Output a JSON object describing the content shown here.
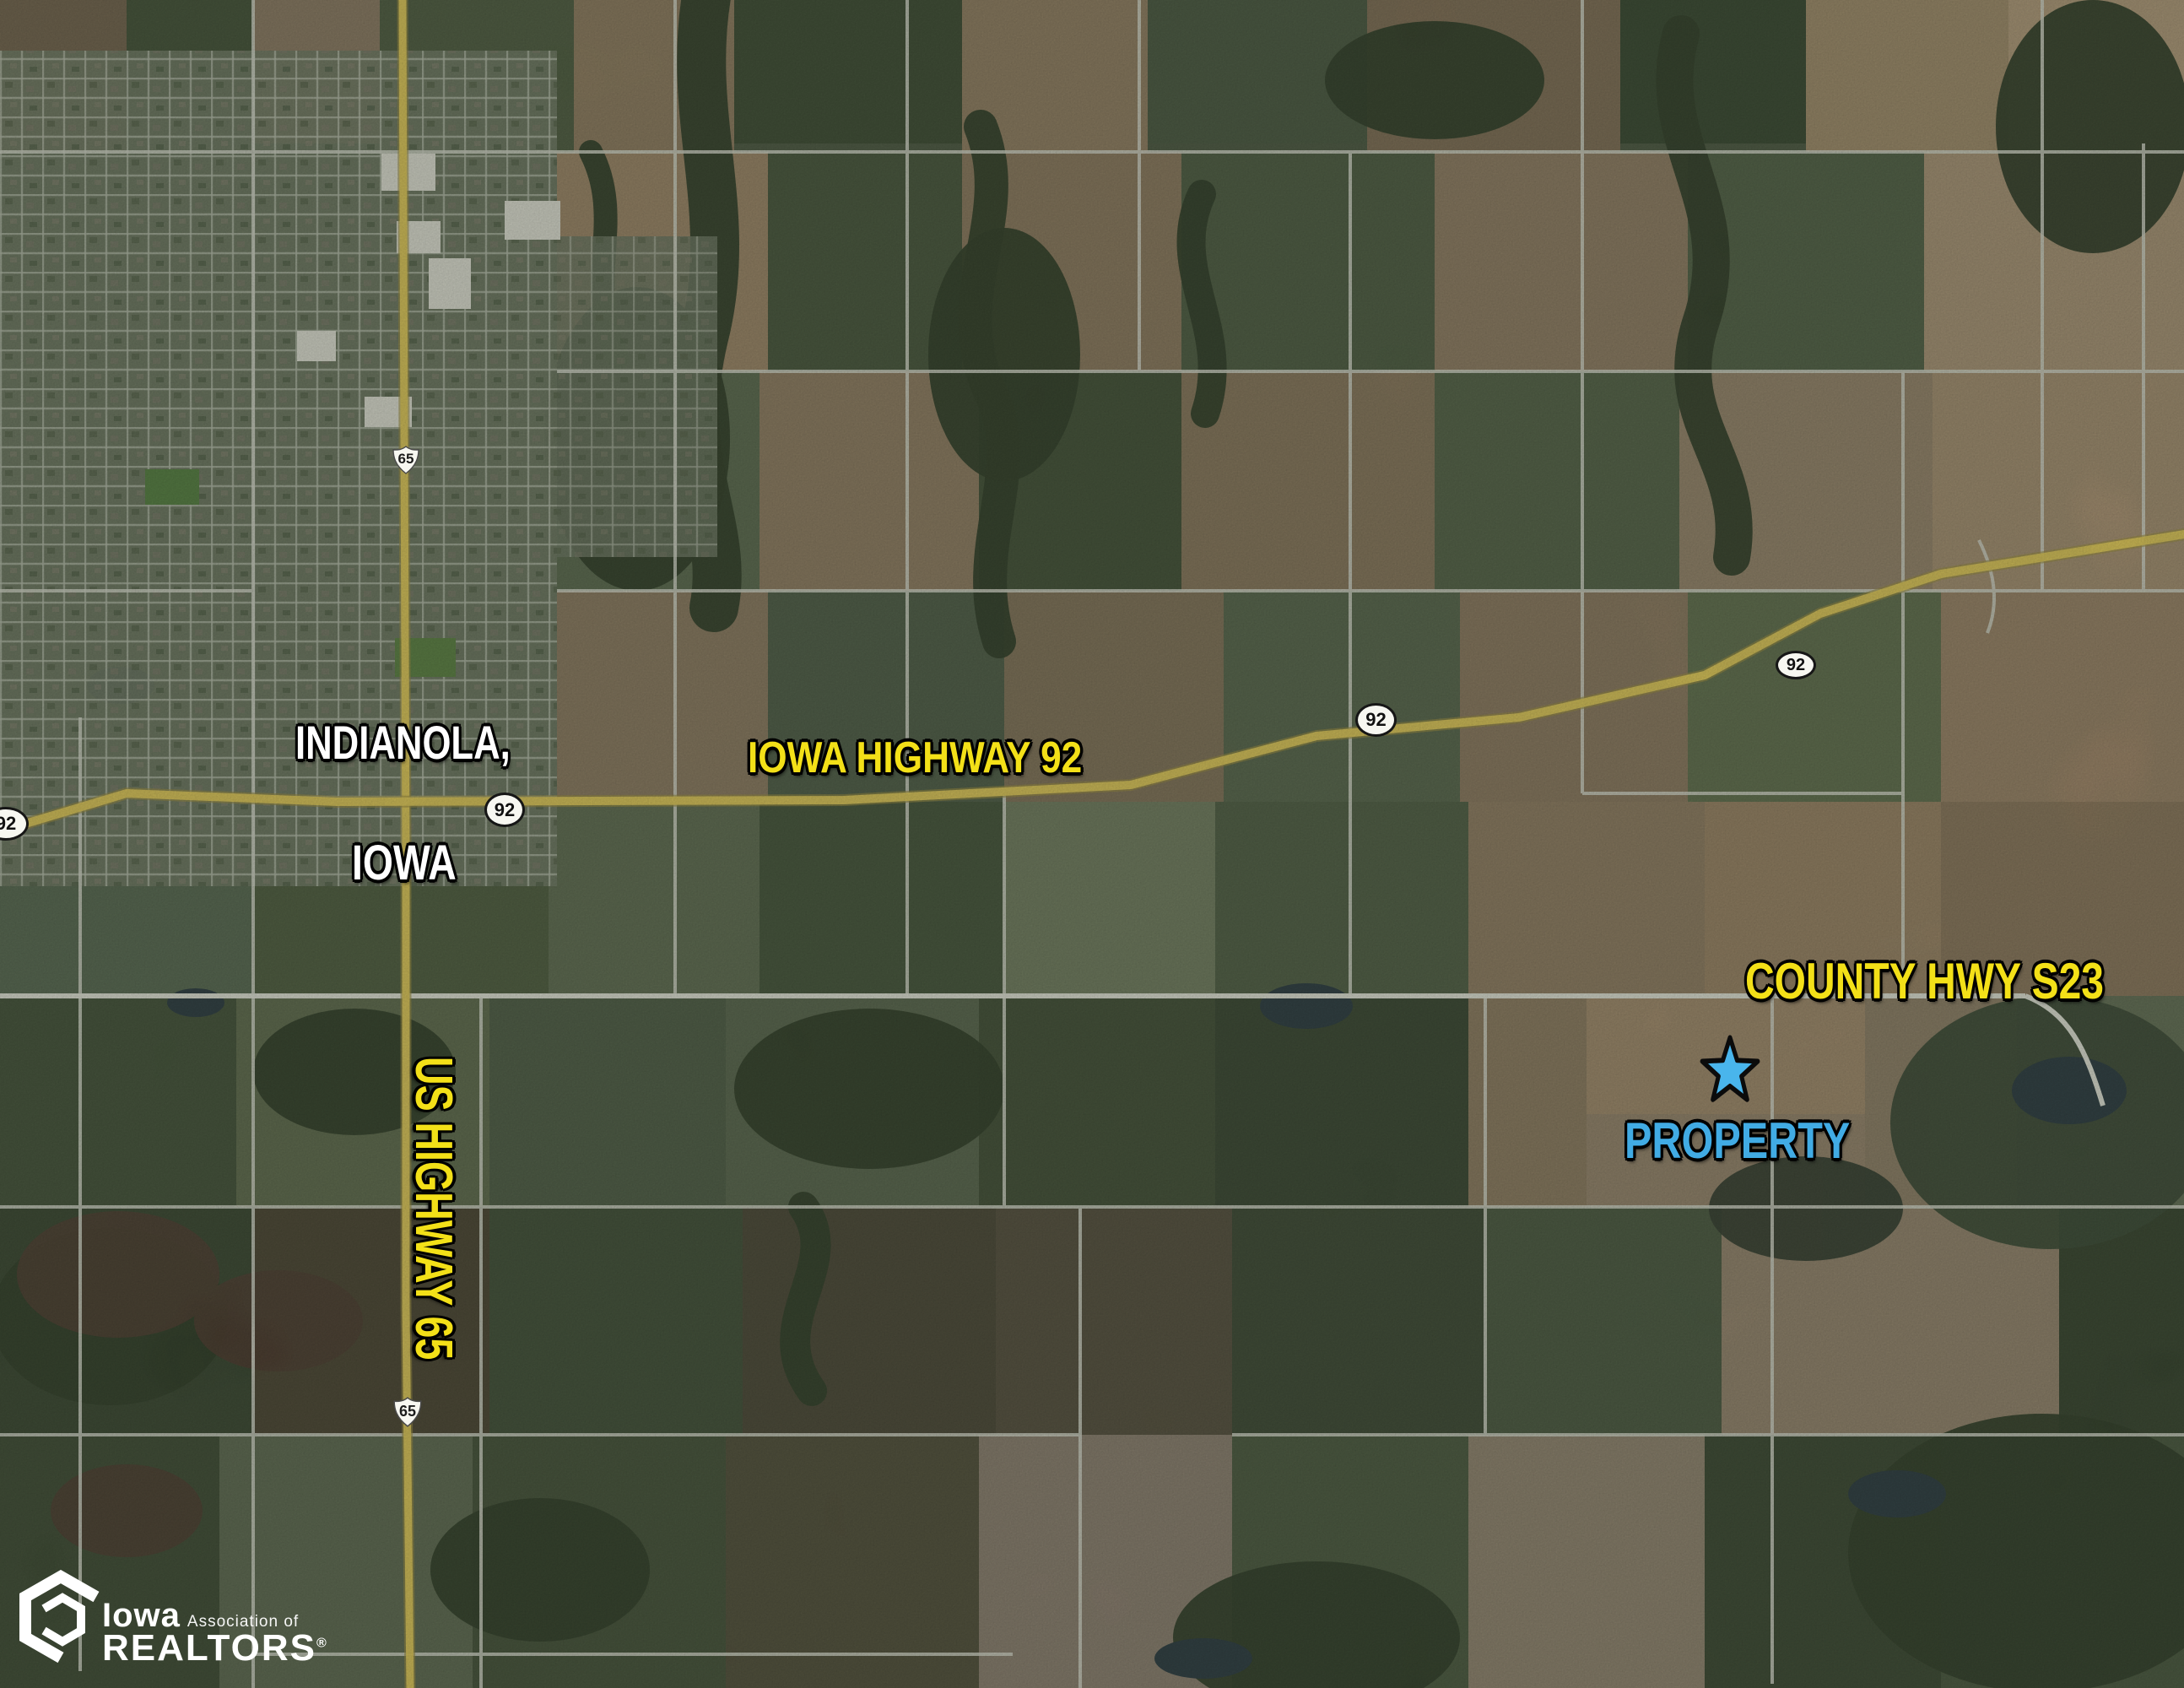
{
  "map": {
    "labels": {
      "city_line1": "INDIANOLA,",
      "city_line2": "IOWA",
      "highway92": "IOWA HIGHWAY 92",
      "highway65": "US HIGHWAY 65",
      "county": "COUNTY HWY S23",
      "property": "PROPERTY"
    },
    "shields": {
      "us65": "65",
      "ia92": "92"
    },
    "colors": {
      "label_yellow": "#f3e018",
      "label_white": "#ffffff",
      "label_blue": "#41abe4",
      "star_blue": "#49b5ec",
      "highway_yellow": "#e7cb55"
    }
  },
  "logo": {
    "brand": "Iowa",
    "subtitle": "Association of",
    "name": "REALTORS",
    "registered": "®"
  }
}
